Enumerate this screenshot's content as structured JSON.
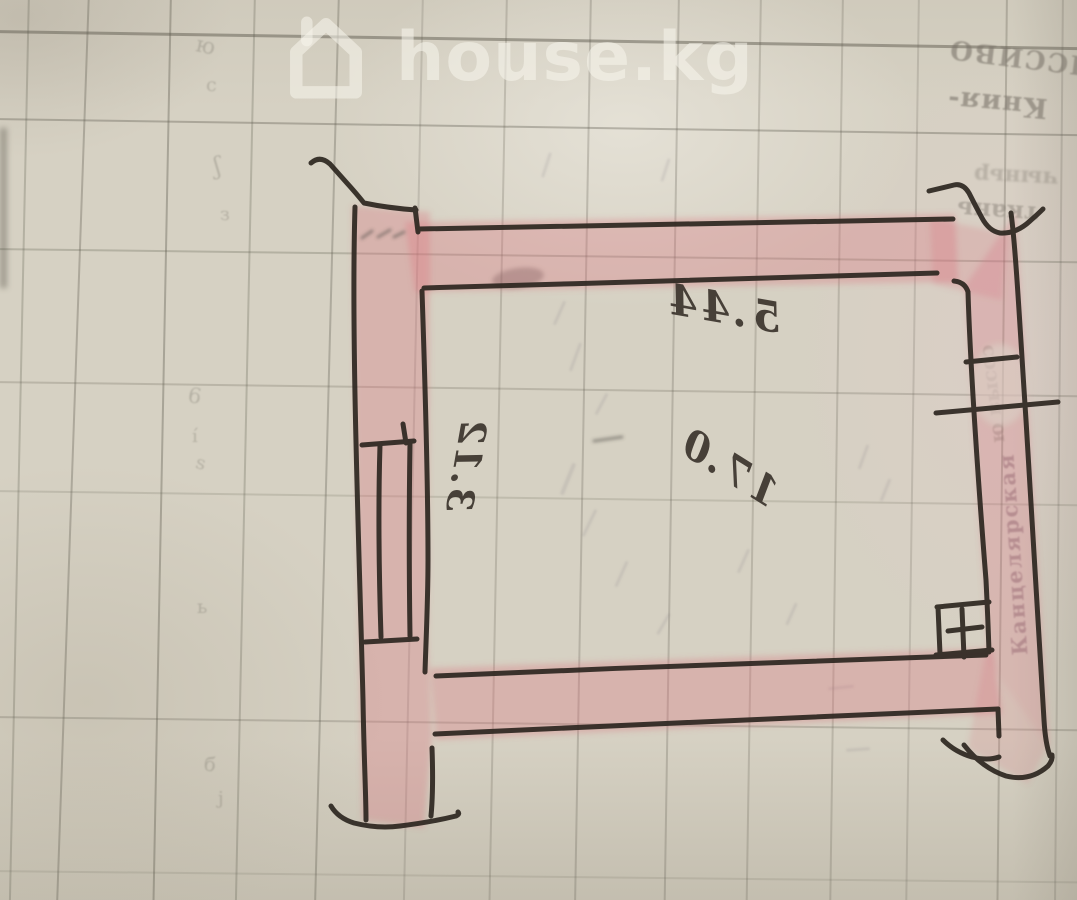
{
  "watermark": {
    "site_name": "house.kg",
    "icon": "house-icon"
  },
  "sketch": {
    "description": "Hand-drawn single-room floor plan in black ink on ledger grid paper, walls shaded pink; dimension numbers are handwritten mirrored/upside-down",
    "labels": {
      "width_dimension": "5.44",
      "side_dimension": "3.12",
      "area": "17.0"
    },
    "features": [
      "window-symbol-left-wall",
      "opening-ticks-right-wall",
      "vent-cross-square-bottom-right",
      "corner-flourishes"
    ],
    "colors": {
      "ink": "#2d2620",
      "wall_highlight": "#d96c7c",
      "paper": "#d6d1c3"
    }
  },
  "paper": {
    "type": "ledger grid paper photo",
    "bleed_through_text": {
      "line1": "ЯССИВО",
      "line2": "Кния-",
      "line3": "чыньр",
      "line4": "ткань",
      "line5": "ю высоɔ",
      "line6": "Канцелярская"
    },
    "pencil_marks": [
      "ю",
      "с",
      "ʃ",
      "з",
      "6",
      "í",
      "ѕ",
      "ь",
      "б",
      "ј"
    ]
  }
}
